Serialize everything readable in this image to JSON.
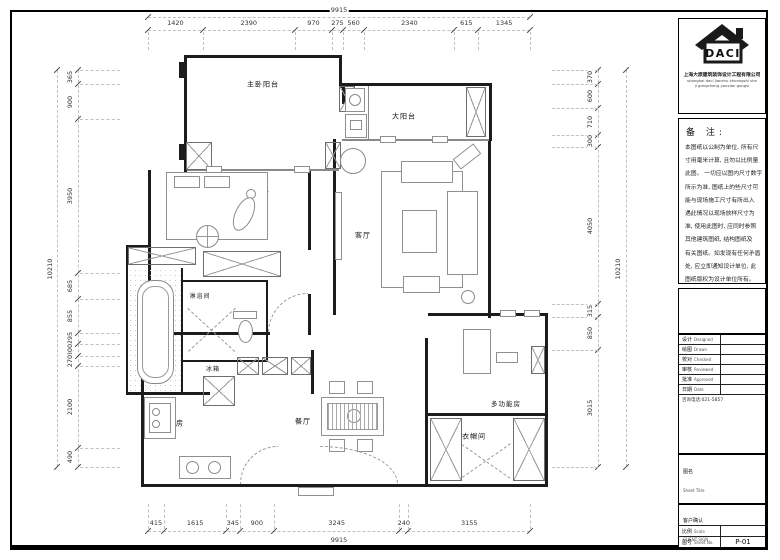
{
  "sheet": {
    "drawing_title": "原始结构图",
    "sheet_no": "P-01"
  },
  "rooms": [
    {
      "id": "master-balcony",
      "label": "主卧阳台"
    },
    {
      "id": "master-bedroom",
      "label": "主卧"
    },
    {
      "id": "big-balcony",
      "label": "大阳台"
    },
    {
      "id": "living-room",
      "label": "客厅"
    },
    {
      "id": "shower-room",
      "label": "淋浴间"
    },
    {
      "id": "bathtub",
      "label": "浴缸"
    },
    {
      "id": "fridge",
      "label": "冰箱"
    },
    {
      "id": "kitchen",
      "label": "厨房"
    },
    {
      "id": "dining-room",
      "label": "餐厅"
    },
    {
      "id": "multi-function-room",
      "label": "多功能房"
    },
    {
      "id": "cloakroom",
      "label": "衣帽间"
    },
    {
      "id": "washing-machine",
      "label": "洗衣机"
    }
  ],
  "dimensions": {
    "top": {
      "total": "9915",
      "segments": [
        1420,
        2390,
        970,
        275,
        560,
        2340,
        615,
        1345
      ]
    },
    "bottom": {
      "total": "9915",
      "segments": [
        415,
        1615,
        345,
        900,
        3245,
        240,
        3155
      ]
    },
    "left": {
      "total": "10210",
      "segments": [
        365,
        900,
        3950,
        685,
        855,
        295,
        300,
        270,
        2100,
        490
      ]
    },
    "right": {
      "total": "10210",
      "segments": [
        370,
        600,
        710,
        300,
        4050,
        315,
        850,
        3015
      ]
    }
  },
  "title_block": {
    "logo_text": "DACI",
    "company_cn": "上海大原建筑装饰设计工程有限公司",
    "company_en1": "shanghai daci jianzhu zhuangshi she",
    "company_en2": "ji gongcheng youxian gongsi",
    "notes_title": "备 注:",
    "notes_lines": [
      "本图纸以公制为单位, 所有尺",
      "寸用毫米计算, 且勿以比例量",
      "此图。 一切应以图内尺寸数字",
      "所示为准, 图纸上的些尺寸可",
      "能与现场施工尺寸有所出入",
      "遇此情况以现场放样尺寸为",
      "准, 使用此图时, 应同时参照",
      "其他建筑图纸, 结构图纸及",
      "有关图纸。如发现有任何矛盾",
      "处, 应立即通知设计单位, 此",
      "图纸版权为设计单位所有。"
    ],
    "fields": [
      {
        "cn": "设计",
        "en": "Designed"
      },
      {
        "cn": "绘图",
        "en": "Drawn"
      },
      {
        "cn": "校对",
        "en": "Checked"
      },
      {
        "cn": "审核",
        "en": "Reviewed"
      },
      {
        "cn": "批准",
        "en": "Approved"
      },
      {
        "cn": "日期",
        "en": "Date"
      }
    ],
    "phone": "咨询电话:021-5857",
    "sheet_title_label_cn": "图名",
    "sheet_title_label_en": "Sheet Title",
    "sheet_title": "原始结构图",
    "client_sign_cn": "客户确认",
    "client_sign_en": "CLIENT SIGN",
    "scale_label_cn": "比例",
    "scale_label_en": "Scale",
    "scale_value": "",
    "sheet_no_label_cn": "图号",
    "sheet_no_label_en": "Sheet No.",
    "sheet_no": "P-01"
  }
}
